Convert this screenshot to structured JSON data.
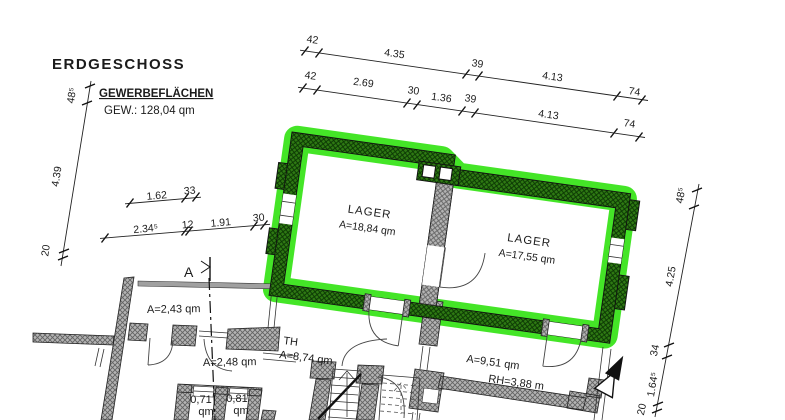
{
  "header": {
    "title": "ERDGESCHOSS",
    "subtitle": "GEWERBEFLÄCHEN",
    "total": "GEW.: 128,04 qm"
  },
  "rooms": {
    "lager_left": {
      "name": "LAGER",
      "area": "A=18,84 qm"
    },
    "lager_right": {
      "name": "LAGER",
      "area": "A=17,55 qm"
    },
    "room_243": {
      "area": "A=2,43 qm"
    },
    "room_248": {
      "area": "A=2,48 qm"
    },
    "stairwell": {
      "name": "TH",
      "area": "A=8,74 qm"
    },
    "room_951": {
      "area": "A=9,51 qm",
      "height": "RH=3,88 m"
    },
    "closet_left": {
      "area": "0,71",
      "unit": "qm"
    },
    "closet_right": {
      "area": "0,81",
      "unit": "qm"
    }
  },
  "section_marker": {
    "label": "A"
  },
  "dimensions": {
    "top_outer": [
      "42",
      "4.35",
      "39",
      "4.13",
      "74"
    ],
    "top_inner": [
      "42",
      "2.69",
      "30",
      "1.36",
      "39",
      "4.13",
      "74"
    ],
    "left": [
      "48⁵",
      "4.39",
      "20"
    ],
    "right": [
      "48⁵",
      "4.25",
      "34",
      "1.64⁵",
      "20"
    ],
    "mid_upper": [
      "1.62",
      "33"
    ],
    "mid_lower": [
      "2.34⁵",
      "12",
      "1.91",
      "30"
    ]
  },
  "colors": {
    "highlight": "#3ce41e",
    "wall_green": "#2f7a13",
    "wall_green_hatch": "#0a3503",
    "wall_gray": "#b4b4b4",
    "wall_gray_hatch": "#636363"
  }
}
